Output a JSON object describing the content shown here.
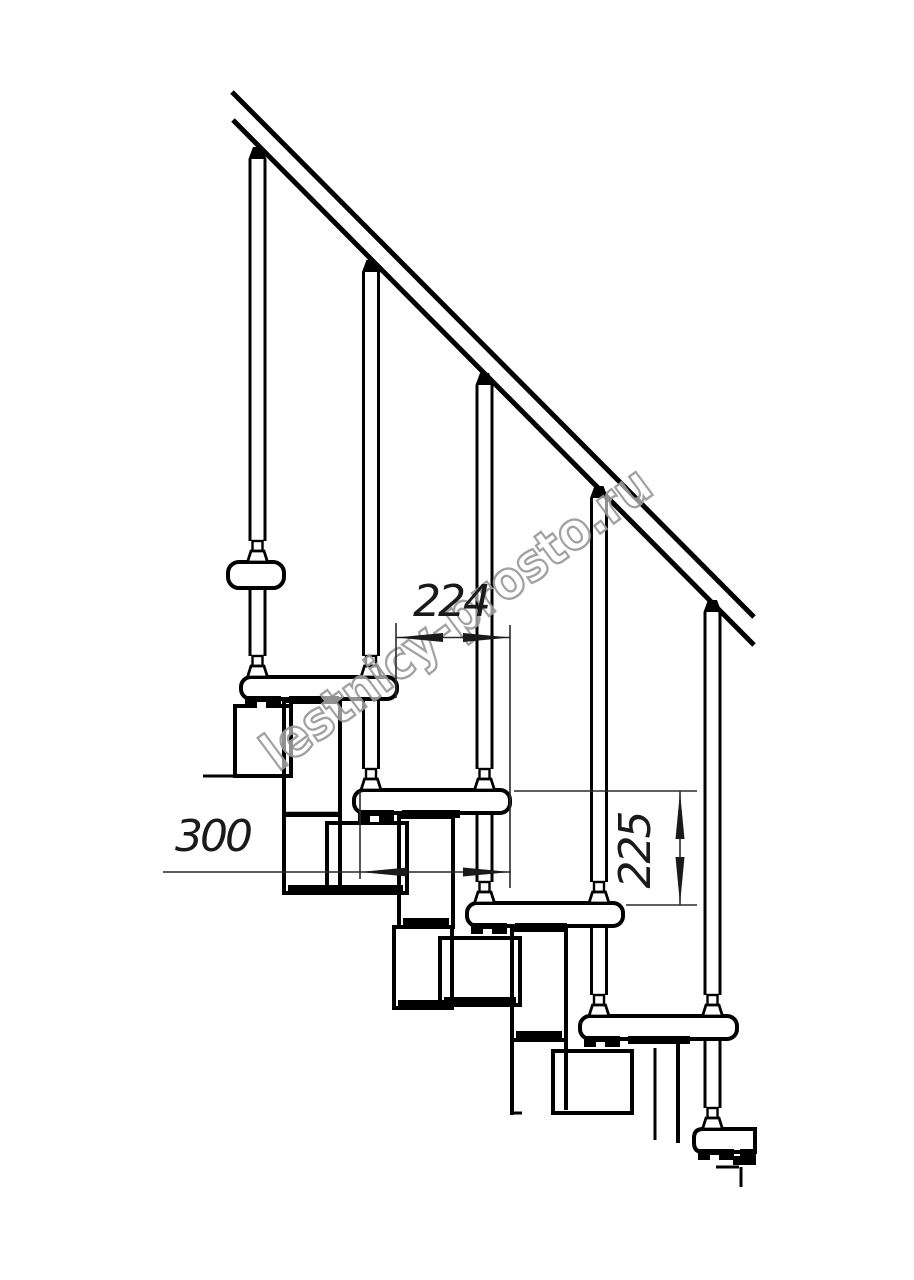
{
  "drawing": {
    "dimensions": {
      "going": {
        "value": "224"
      },
      "depth": {
        "value": "300"
      },
      "rise": {
        "value": "225"
      }
    },
    "watermark": {
      "text": "lestnicy-prosto.ru"
    },
    "colors": {
      "line": "#000000",
      "dim_line": "#2a2a2a",
      "watermark": "#9a9a9a",
      "background": "#ffffff"
    }
  }
}
